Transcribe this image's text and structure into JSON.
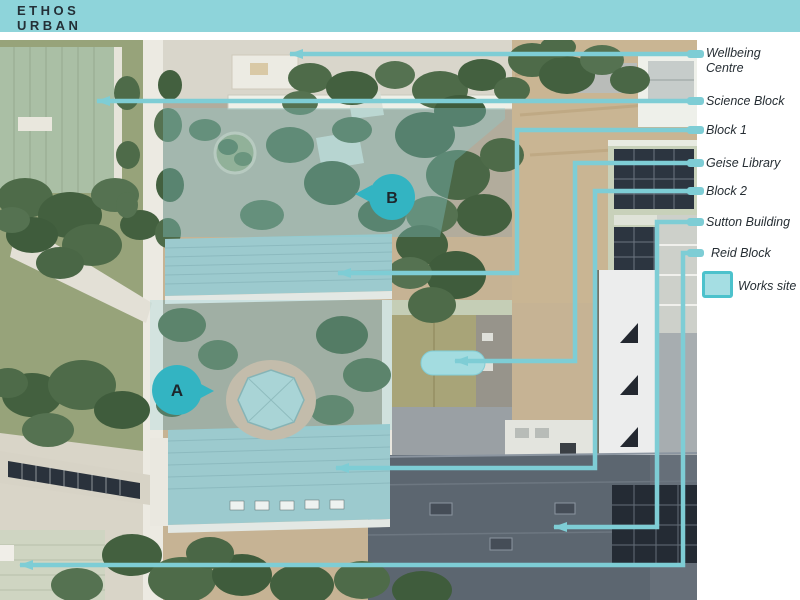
{
  "brand": {
    "line1": "ETHOS",
    "line2": "URBAN"
  },
  "legend": {
    "callouts": [
      {
        "label": "Wellbeing Centre"
      },
      {
        "label": "Science Block"
      },
      {
        "label": "Block 1"
      },
      {
        "label": "Geise Library"
      },
      {
        "label": "Block 2"
      },
      {
        "label": "Sutton Building"
      },
      {
        "label": "Reid Block"
      }
    ],
    "works_site": {
      "label": "Works site"
    }
  },
  "markers": [
    {
      "letter": "A"
    },
    {
      "letter": "B"
    }
  ],
  "colors": {
    "top_bar": "#8ed4da",
    "callout_line": "#7ecdd5",
    "marker_fill": "#33b4c2",
    "works_swatch_fill": "#a5dee3",
    "works_swatch_border": "#4cc2cc",
    "label_text": "#262e34"
  }
}
